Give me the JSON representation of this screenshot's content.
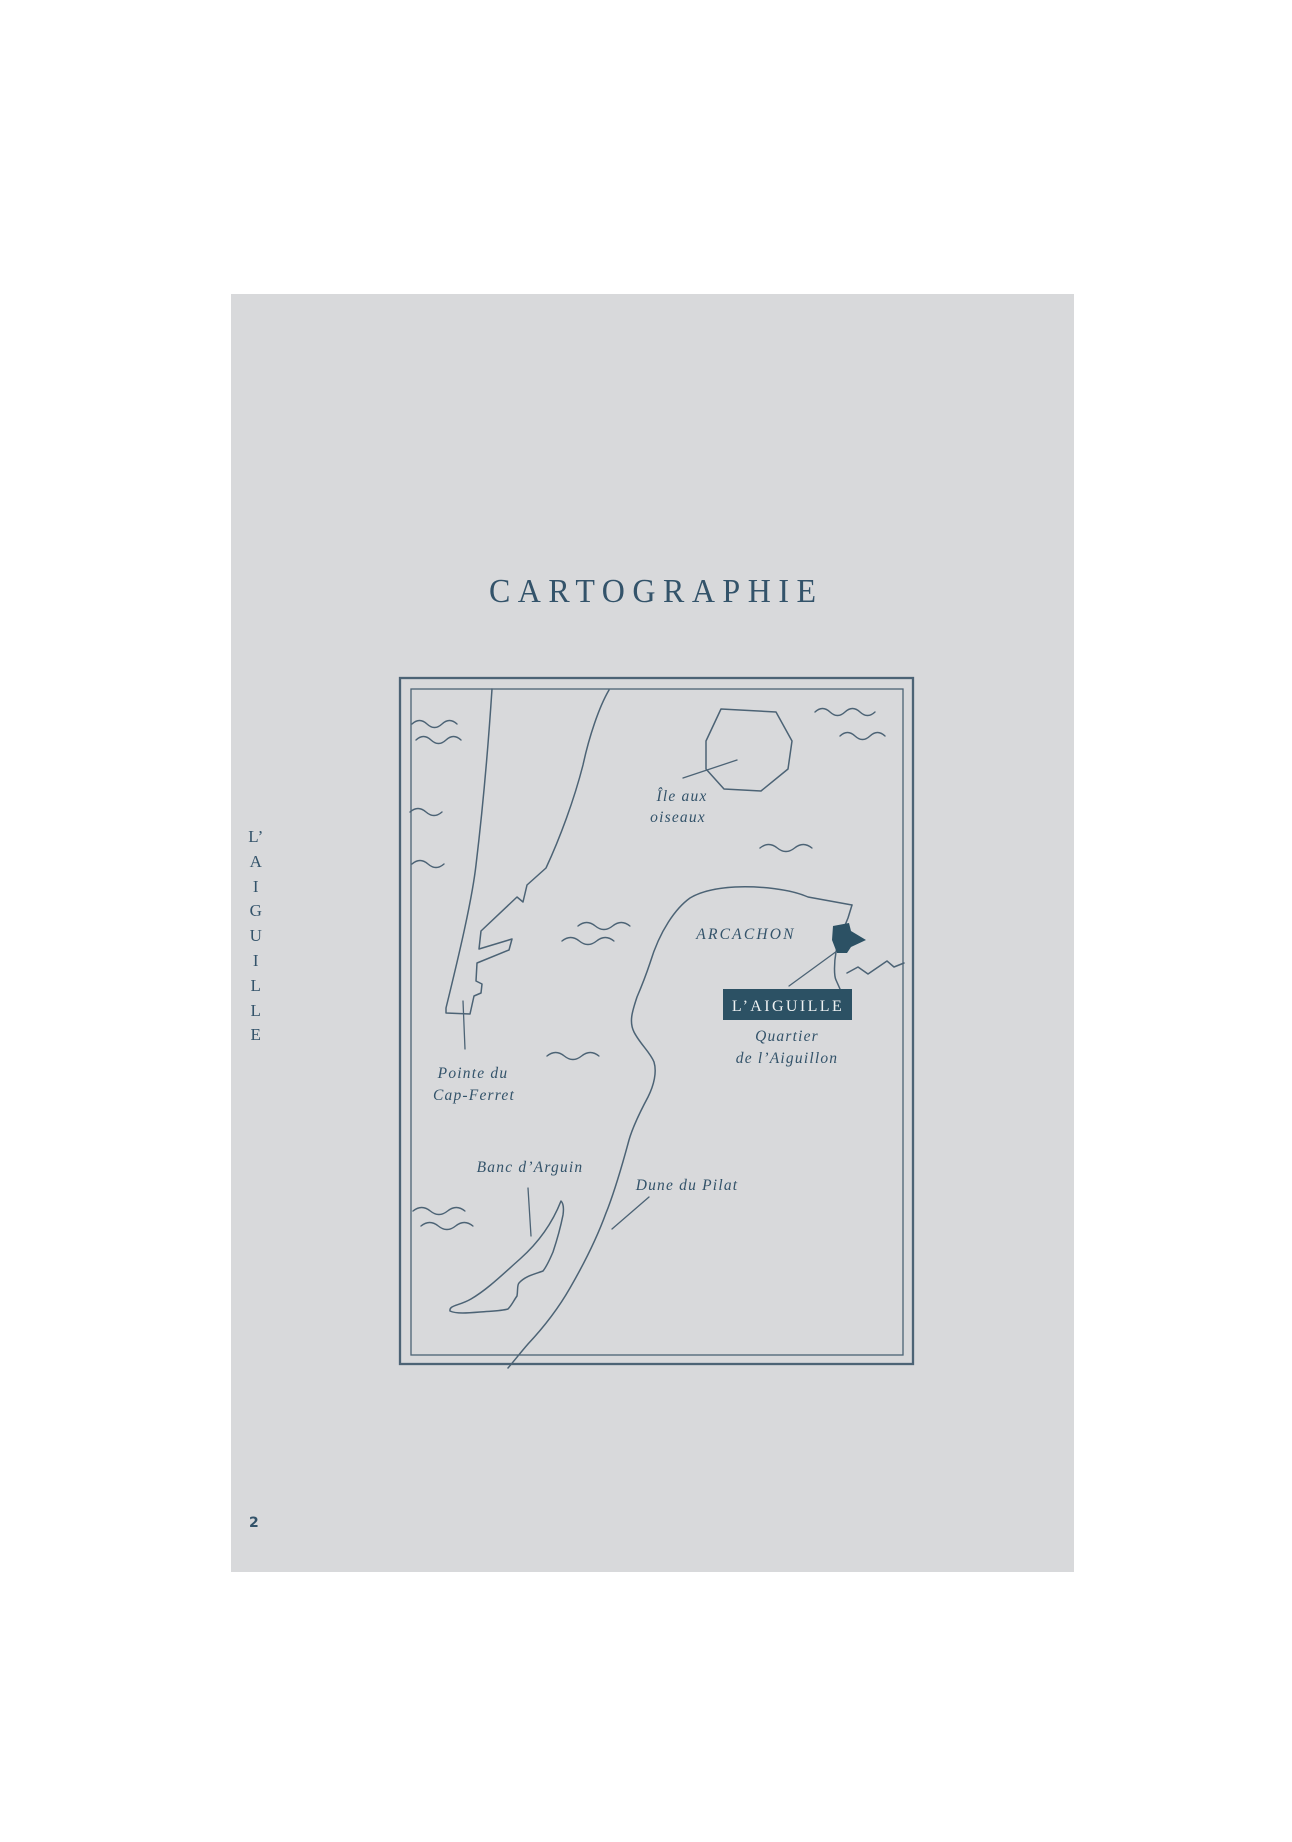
{
  "colors": {
    "page_bg": "#d8d9db",
    "ink": "#33536a",
    "line": "#4c6375",
    "highlight_bg": "#2c5164",
    "highlight_text": "#eef1f2"
  },
  "page": {
    "title": "CARTOGRAPHIE",
    "number": "2"
  },
  "spine": {
    "letters": [
      "L’",
      "A",
      "I",
      "G",
      "U",
      "I",
      "L",
      "L",
      "E"
    ]
  },
  "map": {
    "island_label_line1": "Île aux",
    "island_label_line2": "oiseaux",
    "city_label": "ARCACHON",
    "highlight_label": "L’AIGUILLE",
    "district_label_line1": "Quartier",
    "district_label_line2": "de l’Aiguillon",
    "cape_label_line1": "Pointe du",
    "cape_label_line2": "Cap-Ferret",
    "sandbank_label": "Banc d’Arguin",
    "dune_label": "Dune du Pilat"
  }
}
